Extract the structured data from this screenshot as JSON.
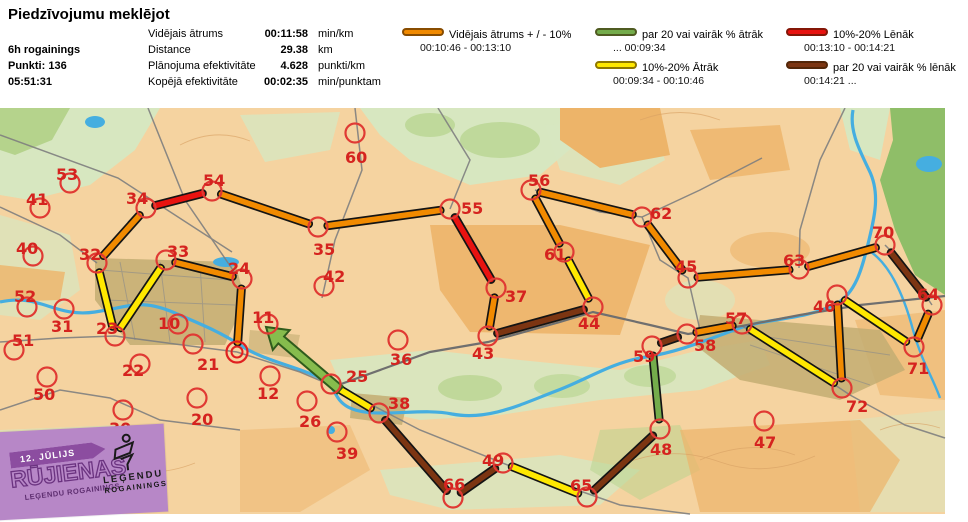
{
  "header": {
    "title": "Piedzīvojumu meklējot",
    "event": {
      "name": "6h rogainings",
      "points": "Punkti: 136",
      "time": "05:51:31"
    },
    "stats": [
      {
        "label": "Vidējais ātrums",
        "value": "00:11:58",
        "unit": "min/km"
      },
      {
        "label": "Distance",
        "value": "29.38",
        "unit": "km"
      },
      {
        "label": "Plānojuma efektivitāte",
        "value": "4.628",
        "unit": "punkti/km"
      },
      {
        "label": "Kopējā efektivitāte",
        "value": "00:02:35",
        "unit": "min/punktam"
      }
    ],
    "legend": [
      {
        "key": "avg",
        "label": "Vidējais ātrums + / - 10%",
        "range": "00:10:46   -   00:13:10"
      },
      {
        "key": "fast20",
        "label": "par 20 vai vairāk % ātrāk",
        "range": "...    00:09:34"
      },
      {
        "key": "fast10",
        "label": "10%-20% Ātrāk",
        "range": "00:09:34   -   00:10:46"
      },
      {
        "key": "slow10",
        "label": "10%-20% Lēnāk",
        "range": "00:13:10   - 00:14:21"
      },
      {
        "key": "slow20",
        "label": "par 20 vai vairāk % lēnāk",
        "range": "00:14:21   ..."
      }
    ]
  },
  "map": {
    "palette": {
      "avg": "#F18A00",
      "fast20": "#74AC4B",
      "fast10": "#FFE800",
      "slow10": "#E81310",
      "slow20": "#7C3512"
    },
    "circle_color": "#E03A34",
    "label_color": "#D5231F",
    "start": {
      "x": 237,
      "y": 352
    },
    "controls": [
      {
        "n": "53",
        "cx": 70,
        "cy": 183,
        "lx": 56,
        "ly": 166
      },
      {
        "n": "41",
        "cx": 40,
        "cy": 208,
        "lx": 26,
        "ly": 191
      },
      {
        "n": "34",
        "cx": 146,
        "cy": 208,
        "lx": 126,
        "ly": 190
      },
      {
        "n": "54",
        "cx": 212,
        "cy": 191,
        "lx": 203,
        "ly": 172
      },
      {
        "n": "40",
        "cx": 33,
        "cy": 256,
        "lx": 16,
        "ly": 240
      },
      {
        "n": "32",
        "cx": 97,
        "cy": 263,
        "lx": 79,
        "ly": 246
      },
      {
        "n": "33",
        "cx": 166,
        "cy": 260,
        "lx": 167,
        "ly": 243
      },
      {
        "n": "24",
        "cx": 242,
        "cy": 279,
        "lx": 228,
        "ly": 260
      },
      {
        "n": "52",
        "cx": 27,
        "cy": 307,
        "lx": 14,
        "ly": 288
      },
      {
        "n": "35",
        "cx": 318,
        "cy": 227,
        "lx": 313,
        "ly": 241
      },
      {
        "n": "60",
        "cx": 355,
        "cy": 133,
        "lx": 345,
        "ly": 149
      },
      {
        "n": "42",
        "cx": 324,
        "cy": 286,
        "lx": 323,
        "ly": 268
      },
      {
        "n": "55",
        "cx": 450,
        "cy": 209,
        "lx": 461,
        "ly": 200
      },
      {
        "n": "56",
        "cx": 531,
        "cy": 190,
        "lx": 528,
        "ly": 172
      },
      {
        "n": "62",
        "cx": 642,
        "cy": 217,
        "lx": 650,
        "ly": 205
      },
      {
        "n": "61",
        "cx": 564,
        "cy": 252,
        "lx": 544,
        "ly": 246
      },
      {
        "n": "37",
        "cx": 496,
        "cy": 288,
        "lx": 505,
        "ly": 288
      },
      {
        "n": "45",
        "cx": 688,
        "cy": 278,
        "lx": 675,
        "ly": 258
      },
      {
        "n": "63",
        "cx": 799,
        "cy": 269,
        "lx": 783,
        "ly": 252
      },
      {
        "n": "70",
        "cx": 885,
        "cy": 245,
        "lx": 872,
        "ly": 224
      },
      {
        "n": "64",
        "cx": 932,
        "cy": 305,
        "lx": 917,
        "ly": 286
      },
      {
        "n": "71",
        "cx": 914,
        "cy": 347,
        "lx": 907,
        "ly": 360
      },
      {
        "n": "46",
        "cx": 837,
        "cy": 295,
        "lx": 813,
        "ly": 298
      },
      {
        "n": "72",
        "cx": 842,
        "cy": 388,
        "lx": 846,
        "ly": 398
      },
      {
        "n": "47",
        "cx": 764,
        "cy": 421,
        "lx": 754,
        "ly": 434
      },
      {
        "n": "57",
        "cx": 742,
        "cy": 324,
        "lx": 725,
        "ly": 310
      },
      {
        "n": "58",
        "cx": 687,
        "cy": 334,
        "lx": 694,
        "ly": 337
      },
      {
        "n": "59",
        "cx": 652,
        "cy": 346,
        "lx": 633,
        "ly": 348
      },
      {
        "n": "48",
        "cx": 660,
        "cy": 429,
        "lx": 650,
        "ly": 441
      },
      {
        "n": "65",
        "cx": 587,
        "cy": 497,
        "lx": 570,
        "ly": 477
      },
      {
        "n": "49",
        "cx": 503,
        "cy": 463,
        "lx": 482,
        "ly": 452
      },
      {
        "n": "66",
        "cx": 453,
        "cy": 498,
        "lx": 443,
        "ly": 476
      },
      {
        "n": "38",
        "cx": 379,
        "cy": 413,
        "lx": 388,
        "ly": 395
      },
      {
        "n": "36",
        "cx": 398,
        "cy": 340,
        "lx": 390,
        "ly": 351
      },
      {
        "n": "25",
        "cx": 331,
        "cy": 384,
        "lx": 346,
        "ly": 368
      },
      {
        "n": "43",
        "cx": 488,
        "cy": 336,
        "lx": 472,
        "ly": 345
      },
      {
        "n": "44",
        "cx": 593,
        "cy": 307,
        "lx": 578,
        "ly": 315
      },
      {
        "n": "39",
        "cx": 337,
        "cy": 432,
        "lx": 336,
        "ly": 445
      },
      {
        "n": "23",
        "cx": 115,
        "cy": 336,
        "lx": 96,
        "ly": 320
      },
      {
        "n": "31",
        "cx": 64,
        "cy": 309,
        "lx": 51,
        "ly": 318
      },
      {
        "n": "51",
        "cx": 14,
        "cy": 350,
        "lx": 12,
        "ly": 332
      },
      {
        "n": "50",
        "cx": 47,
        "cy": 377,
        "lx": 33,
        "ly": 386
      },
      {
        "n": "10",
        "cx": 178,
        "cy": 324,
        "lx": 158,
        "ly": 315
      },
      {
        "n": "11",
        "cx": 268,
        "cy": 324,
        "lx": 252,
        "ly": 309
      },
      {
        "n": "22",
        "cx": 140,
        "cy": 364,
        "lx": 122,
        "ly": 362
      },
      {
        "n": "21",
        "cx": 193,
        "cy": 344,
        "lx": 197,
        "ly": 356
      },
      {
        "n": "30",
        "cx": 123,
        "cy": 410,
        "lx": 109,
        "ly": 420
      },
      {
        "n": "20",
        "cx": 197,
        "cy": 398,
        "lx": 191,
        "ly": 411
      },
      {
        "n": "12",
        "cx": 270,
        "cy": 376,
        "lx": 257,
        "ly": 385
      },
      {
        "n": "26",
        "cx": 307,
        "cy": 401,
        "lx": 299,
        "ly": 413
      }
    ],
    "legs": [
      [
        "S",
        "24",
        "avg"
      ],
      [
        "24",
        "33",
        "avg"
      ],
      [
        "33",
        "23",
        "fast10"
      ],
      [
        "23",
        "32",
        "fast10"
      ],
      [
        "32",
        "34",
        "avg"
      ],
      [
        "34",
        "54",
        "slow10"
      ],
      [
        "54",
        "35",
        "avg"
      ],
      [
        "35",
        "55",
        "avg"
      ],
      [
        "55",
        "37",
        "slow10"
      ],
      [
        "37",
        "43",
        "avg"
      ],
      [
        "43",
        "44",
        "slow20"
      ],
      [
        "44",
        "61",
        "fast10"
      ],
      [
        "61",
        "56",
        "avg"
      ],
      [
        "56",
        "62",
        "avg"
      ],
      [
        "62",
        "45",
        "avg"
      ],
      [
        "45",
        "63",
        "avg"
      ],
      [
        "63",
        "70",
        "avg"
      ],
      [
        "70",
        "64",
        "slow20"
      ],
      [
        "64",
        "71",
        "avg"
      ],
      [
        "71",
        "46",
        "fast10"
      ],
      [
        "46",
        "72",
        "avg"
      ],
      [
        "72",
        "57",
        "fast10"
      ],
      [
        "57",
        "58",
        "avg"
      ],
      [
        "58",
        "59",
        "slow20"
      ],
      [
        "59",
        "48",
        "fast20"
      ],
      [
        "48",
        "65",
        "slow20"
      ],
      [
        "65",
        "49",
        "fast10"
      ],
      [
        "49",
        "66",
        "slow20"
      ],
      [
        "66",
        "38",
        "slow20"
      ],
      [
        "38",
        "25",
        "fast10"
      ]
    ],
    "arrow": {
      "tail_x": 340,
      "tail_y": 390,
      "head_x": 266,
      "head_y": 327,
      "fill": "#86BC4D",
      "border": "#2F5B1C"
    }
  },
  "logo": {
    "date": "12. JŪLIJS",
    "title": "RŪJIENAS",
    "subtitle": "LEĢENDU ROGAININGS",
    "brand_line1": "LEĢENDU",
    "brand_line2": "ROGAININGS"
  }
}
